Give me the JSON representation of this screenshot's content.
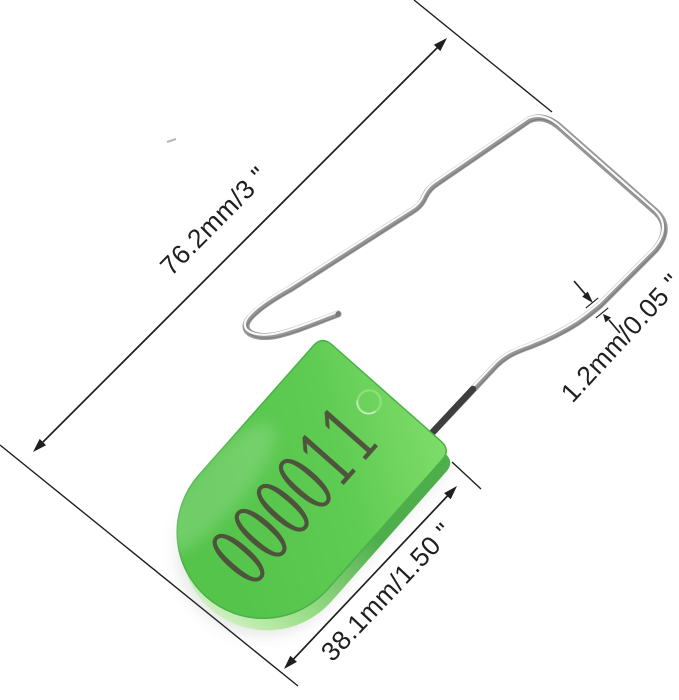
{
  "image": {
    "type": "product-dimension-diagram",
    "subject": "plastic padlock security seal with wire shackle",
    "background_color": "#ffffff"
  },
  "seal": {
    "serial_number": "000011",
    "tag": {
      "face_color_top": "#7edc69",
      "face_color_mid": "#5ecb52",
      "face_color_bottom": "#55c44b",
      "edge_color": "#49b247",
      "side_color_dark": "#4fae4c",
      "side_color_mid": "#9fe08d",
      "side_color_light": "#ddf5cf",
      "hole_ring_color": "#8fdf7d",
      "engraving_color": "#4e4b3b"
    },
    "wire": {
      "color": "#979797",
      "highlight_color": "#ffffff",
      "stub_color": "#3e3e3e"
    }
  },
  "annotations": {
    "color": "#1f1f1f",
    "total_length_label": "76.2mm/3 \"",
    "tag_length_label": "38.1mm/1.50 \"",
    "wire_diameter_label": "1.2mm/0.05 \""
  }
}
